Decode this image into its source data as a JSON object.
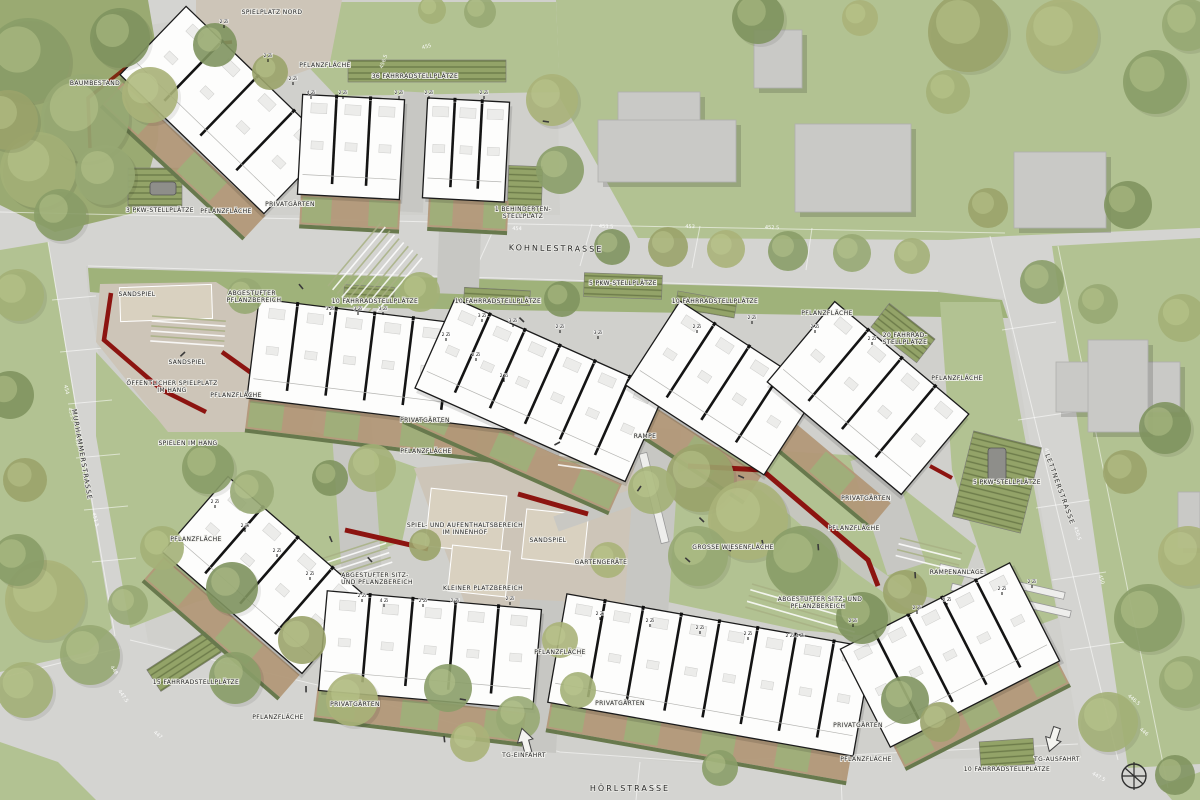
{
  "map": {
    "street_labels": [
      {
        "text": "KOHNLESTRASSE",
        "x": 556,
        "y": 251,
        "rot": 1,
        "size": 8,
        "sp": 2
      },
      {
        "text": "HÖRLSTRASSE",
        "x": 630,
        "y": 791,
        "rot": 0,
        "size": 8,
        "sp": 2
      },
      {
        "text": "MURHAMMERSTRASSE",
        "x": 80,
        "y": 455,
        "rot": 80,
        "size": 6.5,
        "sp": 1.2
      },
      {
        "text": "LETTNERSTRASSE",
        "x": 1058,
        "y": 490,
        "rot": 70,
        "size": 6.5,
        "sp": 1.2
      }
    ],
    "area_labels": [
      {
        "text": "BAUMBESTAND",
        "x": 95,
        "y": 85
      },
      {
        "text": "SPIELPLATZ NORD",
        "x": 272,
        "y": 14
      },
      {
        "text": "PFLANZFLÄCHE",
        "x": 325,
        "y": 67
      },
      {
        "text": "36 FAHRRADSTELLPLÄTZE",
        "x": 415,
        "y": 78
      },
      {
        "text": "3 PKW-STELLPLÄTZE",
        "x": 160,
        "y": 212
      },
      {
        "text": "PFLANZFLÄCHE",
        "x": 226,
        "y": 213
      },
      {
        "text": "PRIVATGÄRTEN",
        "x": 290,
        "y": 206
      },
      {
        "text": "1 BEHINDERTEN-",
        "x": 523,
        "y": 211
      },
      {
        "text": "STELLPLATZ",
        "x": 523,
        "y": 218
      },
      {
        "text": "SANDSPIEL",
        "x": 137,
        "y": 296
      },
      {
        "text": "ABGESTUFTER",
        "x": 252,
        "y": 295
      },
      {
        "text": "PFLANZBEREICH",
        "x": 254,
        "y": 302
      },
      {
        "text": "10 FAHRRADSTELLPLÄTZE",
        "x": 375,
        "y": 303
      },
      {
        "text": "10 FAHRRADSTELLPLÄTZE",
        "x": 498,
        "y": 303
      },
      {
        "text": "5 PKW-STELLPLÄTZE",
        "x": 623,
        "y": 285
      },
      {
        "text": "10 FAHRRADSTELLPLÄTZE",
        "x": 715,
        "y": 303
      },
      {
        "text": "PFLANZFLÄCHE",
        "x": 827,
        "y": 315
      },
      {
        "text": "20 FAHRRAD-",
        "x": 905,
        "y": 337
      },
      {
        "text": "STELLPLÄTZE",
        "x": 905,
        "y": 344
      },
      {
        "text": "PFLANZFLÄCHE",
        "x": 957,
        "y": 380
      },
      {
        "text": "SANDSPIEL",
        "x": 187,
        "y": 364
      },
      {
        "text": "ÖFFENTLICHER SPIELPLATZ",
        "x": 172,
        "y": 385
      },
      {
        "text": "IM HANG",
        "x": 172,
        "y": 392
      },
      {
        "text": "PFLANZFLÄCHE",
        "x": 236,
        "y": 397
      },
      {
        "text": "SPIELEN IM HANG",
        "x": 188,
        "y": 445
      },
      {
        "text": "PRIVATGÄRTEN",
        "x": 425,
        "y": 422
      },
      {
        "text": "PFLANZFLÄCHE",
        "x": 426,
        "y": 453
      },
      {
        "text": "RAMPE",
        "x": 645,
        "y": 438
      },
      {
        "text": "SPIEL- UND AUFENTHALTSBEREICH",
        "x": 465,
        "y": 527
      },
      {
        "text": "IM INNENHOF",
        "x": 465,
        "y": 534
      },
      {
        "text": "SANDSPIEL",
        "x": 548,
        "y": 542
      },
      {
        "text": "GARTENGERÄTE",
        "x": 601,
        "y": 564
      },
      {
        "text": "GROSSE WIESENFLÄCHE",
        "x": 733,
        "y": 549
      },
      {
        "text": "PRIVATGÄRTEN",
        "x": 866,
        "y": 500
      },
      {
        "text": "PFLANZFLÄCHE",
        "x": 854,
        "y": 530
      },
      {
        "text": "5 PKW-STELLPLÄTZE",
        "x": 1007,
        "y": 484
      },
      {
        "text": "RAMPENANLAGE",
        "x": 957,
        "y": 574
      },
      {
        "text": "ABGESTUFTER SITZ-",
        "x": 375,
        "y": 577
      },
      {
        "text": "UND PFLANZBEREICH",
        "x": 377,
        "y": 584
      },
      {
        "text": "KLEINER PLATZBEREICH",
        "x": 483,
        "y": 590
      },
      {
        "text": "ABGESTUFTER SITZ- UND",
        "x": 820,
        "y": 601
      },
      {
        "text": "PFLANZBEREICH",
        "x": 818,
        "y": 608
      },
      {
        "text": "PFLANZFLÄCHE",
        "x": 196,
        "y": 541
      },
      {
        "text": "15 FAHRRADSTELLPLÄTZE",
        "x": 196,
        "y": 684
      },
      {
        "text": "PFLANZFLÄCHE",
        "x": 278,
        "y": 719
      },
      {
        "text": "PRIVATGÄRTEN",
        "x": 355,
        "y": 706
      },
      {
        "text": "PFLANZFLÄCHE",
        "x": 560,
        "y": 654
      },
      {
        "text": "PRIVATGÄRTEN",
        "x": 620,
        "y": 705
      },
      {
        "text": "TG-EINFAHRT",
        "x": 524,
        "y": 757
      },
      {
        "text": "PRIVATGÄRTEN",
        "x": 858,
        "y": 727
      },
      {
        "text": "PFLANZFLÄCHE",
        "x": 866,
        "y": 761
      },
      {
        "text": "10 FAHRRADSTELLPLÄTZE",
        "x": 1007,
        "y": 771
      },
      {
        "text": "TG-AUSFAHRT",
        "x": 1057,
        "y": 761
      }
    ],
    "unit_labels": [
      {
        "text": "2 Zi",
        "x": 224,
        "y": 23
      },
      {
        "text": "2 Zi",
        "x": 268,
        "y": 57
      },
      {
        "text": "2 Zi",
        "x": 293,
        "y": 80
      },
      {
        "text": "4 Zi",
        "x": 311,
        "y": 94
      },
      {
        "text": "2 Zi",
        "x": 343,
        "y": 94
      },
      {
        "text": "2 Zi",
        "x": 399,
        "y": 94
      },
      {
        "text": "2 Zi",
        "x": 429,
        "y": 94
      },
      {
        "text": "2 Zi",
        "x": 484,
        "y": 94
      },
      {
        "text": "3 Zi",
        "x": 330,
        "y": 310
      },
      {
        "text": "3 Zi",
        "x": 358,
        "y": 310
      },
      {
        "text": "3 Zi",
        "x": 383,
        "y": 310
      },
      {
        "text": "3 Zi",
        "x": 482,
        "y": 317
      },
      {
        "text": "3 Zi",
        "x": 513,
        "y": 322
      },
      {
        "text": "2 Zi",
        "x": 560,
        "y": 328
      },
      {
        "text": "3 Zi",
        "x": 598,
        "y": 334
      },
      {
        "text": "2 Zi",
        "x": 446,
        "y": 336
      },
      {
        "text": "2 Zi",
        "x": 476,
        "y": 356
      },
      {
        "text": "2 Zi",
        "x": 504,
        "y": 377
      },
      {
        "text": "2 Zi",
        "x": 697,
        "y": 328
      },
      {
        "text": "2 Zi",
        "x": 752,
        "y": 319
      },
      {
        "text": "2 Zi",
        "x": 815,
        "y": 328
      },
      {
        "text": "2 Zi",
        "x": 872,
        "y": 340
      },
      {
        "text": "2 Zi",
        "x": 215,
        "y": 503
      },
      {
        "text": "2 Zi",
        "x": 245,
        "y": 527
      },
      {
        "text": "2 Zi",
        "x": 277,
        "y": 552
      },
      {
        "text": "2 Zi",
        "x": 310,
        "y": 575
      },
      {
        "text": "2 Zi",
        "x": 362,
        "y": 597
      },
      {
        "text": "4 Zi",
        "x": 384,
        "y": 602
      },
      {
        "text": "2 Zi",
        "x": 423,
        "y": 602
      },
      {
        "text": "2 Zi",
        "x": 455,
        "y": 602
      },
      {
        "text": "2 Zi",
        "x": 510,
        "y": 600
      },
      {
        "text": "2 Zi",
        "x": 600,
        "y": 615
      },
      {
        "text": "2 Zi",
        "x": 650,
        "y": 622
      },
      {
        "text": "2 Zi",
        "x": 700,
        "y": 629
      },
      {
        "text": "2 Zi",
        "x": 748,
        "y": 635
      },
      {
        "text": "2 Zi 4 Zi",
        "x": 795,
        "y": 637
      },
      {
        "text": "2 Zi",
        "x": 853,
        "y": 622
      },
      {
        "text": "2 Zi",
        "x": 917,
        "y": 609
      },
      {
        "text": "2 Zi",
        "x": 947,
        "y": 601
      },
      {
        "text": "2 Zi",
        "x": 1002,
        "y": 590
      },
      {
        "text": "2 Zi",
        "x": 1032,
        "y": 583
      }
    ],
    "elevation_labels": [
      {
        "text": "454",
        "x": 65,
        "y": 390,
        "rot": 76
      },
      {
        "text": "453.5",
        "x": 70,
        "y": 415,
        "rot": 76
      },
      {
        "text": "453",
        "x": 76,
        "y": 442,
        "rot": 76
      },
      {
        "text": "452.5",
        "x": 82,
        "y": 468,
        "rot": 76
      },
      {
        "text": "452",
        "x": 88,
        "y": 494,
        "rot": 76
      },
      {
        "text": "451.5",
        "x": 94,
        "y": 520,
        "rot": 76
      },
      {
        "text": "454",
        "x": 517,
        "y": 230,
        "rot": 2
      },
      {
        "text": "453.5",
        "x": 606,
        "y": 228,
        "rot": 2
      },
      {
        "text": "453",
        "x": 690,
        "y": 228,
        "rot": 2
      },
      {
        "text": "452.5",
        "x": 772,
        "y": 229,
        "rot": 2
      },
      {
        "text": "451",
        "x": 1046,
        "y": 453,
        "rot": 72
      },
      {
        "text": "450.5",
        "x": 1076,
        "y": 534,
        "rot": 72
      },
      {
        "text": "450",
        "x": 1100,
        "y": 580,
        "rot": 72
      },
      {
        "text": "447",
        "x": 658,
        "y": 788,
        "rot": 2
      },
      {
        "text": "446.5",
        "x": 1133,
        "y": 701,
        "rot": 40
      },
      {
        "text": "446",
        "x": 1143,
        "y": 733,
        "rot": 40
      },
      {
        "text": "447.5",
        "x": 1098,
        "y": 778,
        "rot": 30
      },
      {
        "text": "448",
        "x": 113,
        "y": 671,
        "rot": 55
      },
      {
        "text": "447.5",
        "x": 122,
        "y": 697,
        "rot": 55
      },
      {
        "text": "447",
        "x": 157,
        "y": 736,
        "rot": 40
      },
      {
        "text": "456.5",
        "x": 385,
        "y": 62,
        "rot": -70
      },
      {
        "text": "455",
        "x": 427,
        "y": 48,
        "rot": -15
      }
    ]
  },
  "colors": {
    "street": "#d4d4d1",
    "block": "#d0d0cc",
    "lawn": "#b2c292",
    "lawn_dark": "#9fb27a",
    "forest": "#9aaa72",
    "gravel": "#cdc5b8",
    "sand": "#d9d1c0",
    "path": "#c7c7c3",
    "building": "#fdfdfc",
    "building_stroke": "#1b1b1b",
    "existing": "#c9c9c6",
    "garden": "#b29878",
    "hedge": "#68794d",
    "parking": "#8fa368",
    "parking_dark": "#6d7c4a",
    "red_wall": "#8c1410",
    "red_rust": "#7e2a12",
    "label": "#1a1a1a",
    "elevation": "#ffffff",
    "tree_palette": [
      "#8a9d68",
      "#97a873",
      "#a3b077",
      "#7f935f",
      "#9aa36a",
      "#aab379"
    ]
  }
}
